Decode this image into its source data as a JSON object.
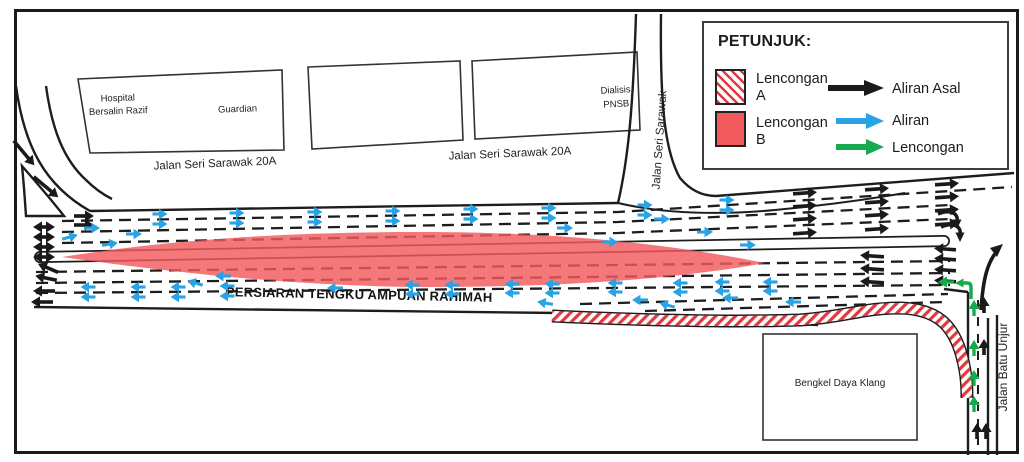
{
  "legend": {
    "title": "PETUNJUK:",
    "zones": [
      {
        "label_line1": "Lencongan",
        "label_line2": "A",
        "style": "hatched"
      },
      {
        "label_line1": "Lencongan",
        "label_line2": "B",
        "style": "solid"
      }
    ],
    "flows": [
      {
        "label": "Aliran Asal",
        "color": "#1a1a1a"
      },
      {
        "label": "Aliran",
        "color": "#29a3e3"
      },
      {
        "label": "Lencongan",
        "color": "#17a94e"
      }
    ]
  },
  "labels": {
    "road_main": "PERSIARAN TENGKU AMPUAN RAHIMAH",
    "road_top_1": "Jalan Seri Sarawak 20A",
    "road_top_2": "Jalan Seri Sarawak 20A",
    "road_vertical_mid": "Jalan Seri Sarawak",
    "road_vertical_right": "Jalan Batu Unjur"
  },
  "buildings": {
    "hospital_line1": "Hospital",
    "hospital_line2": "Bersalin Razif",
    "guardian": "Guardian",
    "dialisis_line1": "Dialisis",
    "dialisis_line2": "PNSB",
    "bengkel": "Bengkel Daya Klang"
  },
  "colors": {
    "zone_b_fill": "#f2595c",
    "hatch_stripe": "#e0393f",
    "road_line": "#1d1d1d",
    "aliran_asal": "#1a1a1a",
    "aliran": "#29a3e3",
    "lencongan": "#17a94e"
  },
  "arrows": {
    "black": [
      [
        44,
        227,
        0,
        22,
        "d"
      ],
      [
        44,
        237,
        0,
        22,
        "d"
      ],
      [
        44,
        247,
        0,
        22,
        "d"
      ],
      [
        44,
        257,
        0,
        22,
        "d"
      ],
      [
        84,
        216,
        0,
        20,
        "s"
      ],
      [
        84,
        225,
        0,
        20,
        "s"
      ],
      [
        48,
        268,
        203,
        22,
        "s"
      ],
      [
        46,
        278,
        192,
        22,
        "s"
      ],
      [
        44,
        291,
        180,
        22,
        "s"
      ],
      [
        42,
        302,
        180,
        22,
        "s"
      ],
      [
        24,
        153,
        50,
        32,
        "s"
      ],
      [
        46,
        187,
        40,
        32,
        "s"
      ],
      [
        805,
        193,
        -4,
        24,
        "s"
      ],
      [
        805,
        206,
        -4,
        24,
        "s"
      ],
      [
        805,
        219,
        -4,
        24,
        "s"
      ],
      [
        805,
        233,
        -4,
        24,
        "s"
      ],
      [
        877,
        189,
        -4,
        24,
        "s"
      ],
      [
        877,
        202,
        -4,
        24,
        "s"
      ],
      [
        877,
        215,
        -4,
        24,
        "s"
      ],
      [
        877,
        229,
        -4,
        24,
        "s"
      ],
      [
        947,
        184,
        -4,
        24,
        "s"
      ],
      [
        947,
        197,
        -4,
        24,
        "s"
      ],
      [
        947,
        210,
        -4,
        24,
        "s"
      ],
      [
        947,
        224,
        -4,
        24,
        "s"
      ],
      [
        872,
        256,
        184,
        24,
        "s"
      ],
      [
        872,
        269,
        184,
        24,
        "s"
      ],
      [
        872,
        282,
        184,
        24,
        "s"
      ],
      [
        945,
        249,
        184,
        22,
        "s"
      ],
      [
        945,
        259,
        184,
        22,
        "s"
      ],
      [
        945,
        270,
        184,
        22,
        "s"
      ],
      [
        945,
        281,
        184,
        22,
        "s"
      ],
      [
        984,
        305,
        270,
        16,
        "s"
      ],
      [
        984,
        347,
        270,
        16,
        "s"
      ],
      [
        977,
        431,
        270,
        16,
        "s"
      ],
      [
        986,
        431,
        270,
        16,
        "s"
      ]
    ],
    "blue": [
      [
        160,
        214,
        0,
        15
      ],
      [
        160,
        224,
        0,
        15
      ],
      [
        237,
        213,
        0,
        15
      ],
      [
        237,
        223,
        0,
        15
      ],
      [
        315,
        212,
        0,
        15
      ],
      [
        315,
        222,
        0,
        15
      ],
      [
        393,
        211,
        0,
        15
      ],
      [
        393,
        221,
        0,
        15
      ],
      [
        471,
        209,
        0,
        15
      ],
      [
        471,
        219,
        0,
        15
      ],
      [
        549,
        208,
        0,
        15
      ],
      [
        549,
        218,
        0,
        15
      ],
      [
        645,
        205,
        0,
        15
      ],
      [
        645,
        215,
        0,
        15
      ],
      [
        727,
        200,
        0,
        15
      ],
      [
        727,
        210,
        0,
        15
      ],
      [
        70,
        237,
        345,
        16
      ],
      [
        92,
        228,
        0,
        16
      ],
      [
        110,
        244,
        350,
        16
      ],
      [
        134,
        234,
        0,
        16
      ],
      [
        565,
        228,
        0,
        16
      ],
      [
        610,
        242,
        0,
        16
      ],
      [
        662,
        219,
        0,
        16
      ],
      [
        705,
        232,
        0,
        16
      ],
      [
        748,
        245,
        0,
        16
      ],
      [
        88,
        287,
        180,
        15
      ],
      [
        88,
        297,
        180,
        15
      ],
      [
        138,
        287,
        180,
        15
      ],
      [
        138,
        297,
        180,
        15
      ],
      [
        178,
        287,
        180,
        15
      ],
      [
        178,
        297,
        180,
        15
      ],
      [
        227,
        286,
        180,
        15
      ],
      [
        227,
        296,
        180,
        15
      ],
      [
        412,
        285,
        180,
        15
      ],
      [
        412,
        294,
        180,
        15
      ],
      [
        452,
        285,
        180,
        15
      ],
      [
        452,
        294,
        180,
        15
      ],
      [
        512,
        284,
        180,
        15
      ],
      [
        512,
        293,
        180,
        15
      ],
      [
        552,
        284,
        180,
        15
      ],
      [
        552,
        293,
        180,
        15
      ],
      [
        615,
        283,
        180,
        15
      ],
      [
        615,
        292,
        180,
        15
      ],
      [
        680,
        283,
        180,
        15
      ],
      [
        680,
        292,
        180,
        15
      ],
      [
        722,
        282,
        180,
        15
      ],
      [
        722,
        291,
        180,
        15
      ],
      [
        770,
        282,
        180,
        15
      ],
      [
        770,
        291,
        180,
        15
      ],
      [
        195,
        283,
        195,
        16
      ],
      [
        223,
        276,
        180,
        16
      ],
      [
        335,
        288,
        180,
        16
      ],
      [
        545,
        303,
        190,
        16
      ],
      [
        640,
        300,
        180,
        16
      ],
      [
        667,
        305,
        195,
        16
      ],
      [
        730,
        298,
        180,
        16
      ],
      [
        793,
        302,
        180,
        16
      ]
    ],
    "green": [
      [
        946,
        282,
        180,
        16
      ],
      [
        974,
        308,
        270,
        16
      ],
      [
        974,
        348,
        270,
        16
      ],
      [
        974,
        378,
        270,
        16
      ],
      [
        974,
        404,
        270,
        16
      ]
    ]
  }
}
